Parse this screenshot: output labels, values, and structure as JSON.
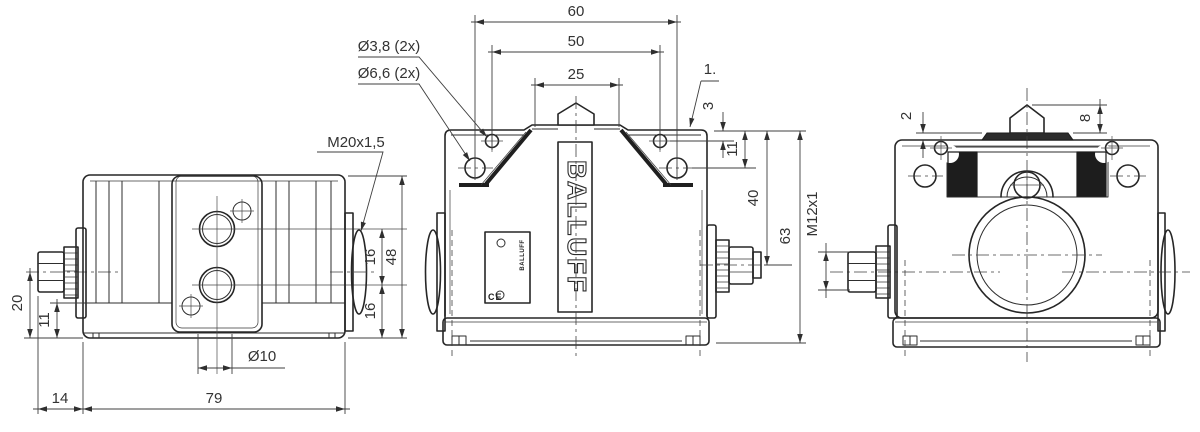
{
  "drawing": {
    "side_view": {
      "thread_label": "M20x1,5",
      "hole_label": "Ø10",
      "dim_20": "20",
      "dim_11": "11",
      "dim_14": "14",
      "dim_79": "79",
      "dim_16_upper": "16",
      "dim_16_lower": "16",
      "dim_48": "48"
    },
    "front_view": {
      "dim_60": "60",
      "dim_50": "50",
      "dim_25": "25",
      "hole_small_label": "Ø3,8 (2x)",
      "hole_large_label": "Ø6,6 (2x)",
      "ref_label": "1.",
      "dim_3": "3",
      "dim_11": "11",
      "dim_40": "40",
      "dim_63": "63",
      "brand_logo": "BALLUFF",
      "nameplate_logo": "BALLUFF",
      "ce_mark": "CE"
    },
    "end_view": {
      "dim_2": "2",
      "dim_8": "8",
      "thread_label": "M12x1"
    }
  }
}
